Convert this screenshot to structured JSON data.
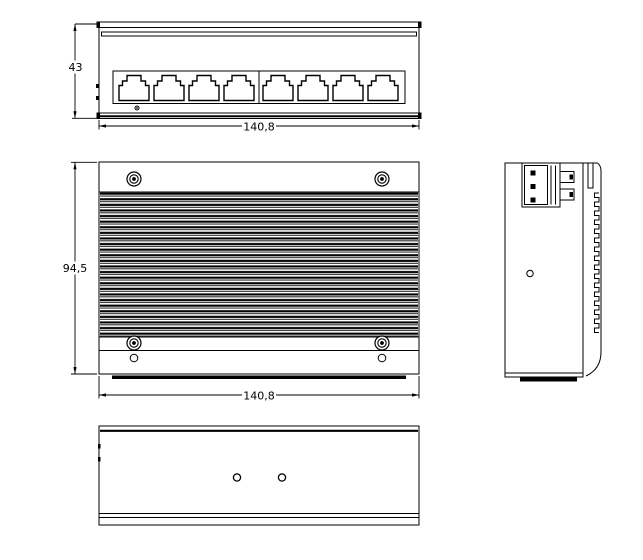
{
  "drawing": {
    "background_color": "#ffffff",
    "line_color": "#000000"
  },
  "dimensions": {
    "front_height_mm": "43",
    "front_width_mm": "140,8",
    "top_depth_mm": "94,5",
    "top_width_mm": "140,8"
  },
  "counts": {
    "ethernet_ports": 8,
    "ports_per_group": 4,
    "top_view_screws": 4,
    "top_view_extra_holes": 2,
    "side_view_holes": 1,
    "bottom_view_holes": 2,
    "terminal_block_pins": 3
  }
}
